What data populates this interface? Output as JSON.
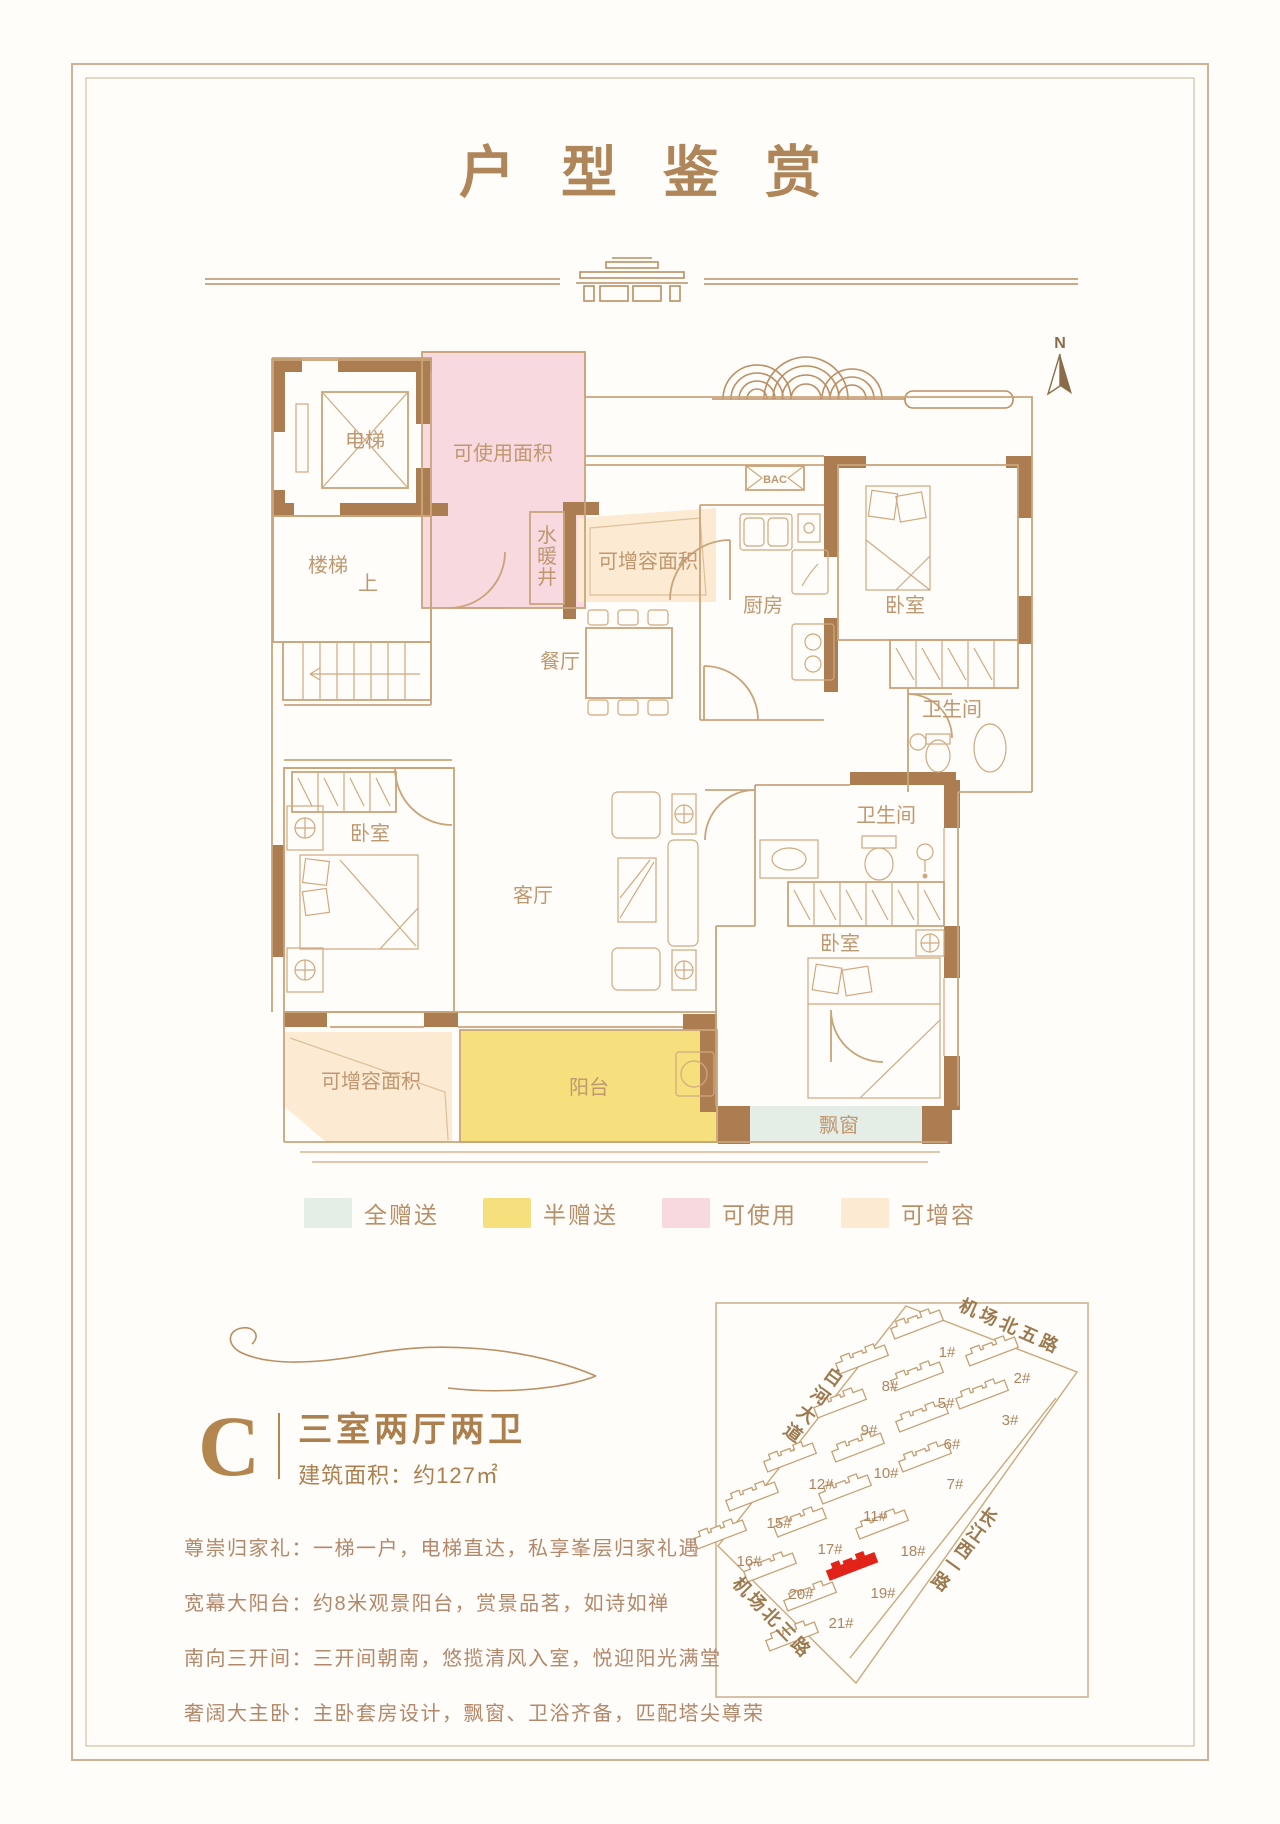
{
  "title": "户型鉴赏",
  "north": "N",
  "plan": {
    "elevator": "电梯",
    "stairs": "楼梯",
    "up": "上",
    "usable": "可使用面积",
    "shaft": [
      "水",
      "暖",
      "井"
    ],
    "expand_top": "可增容面积",
    "vent": "BAC",
    "kitchen": "厨房",
    "bedroom_tr": "卧室",
    "bath_tr": "卫生间",
    "dining": "餐厅",
    "bedroom_l": "卧室",
    "living": "客厅",
    "bath_m": "卫生间",
    "bedroom_m": "卧室",
    "expand_bottom": "可增容面积",
    "balcony": "阳台",
    "bay_window": "飘窗"
  },
  "legend": {
    "items": [
      {
        "label": "全赠送",
        "color": "#e4eee6"
      },
      {
        "label": "半赠送",
        "color": "#f6e07d"
      },
      {
        "label": "可使用",
        "color": "#f9d9e0"
      },
      {
        "label": "可增容",
        "color": "#fcead2"
      }
    ]
  },
  "unit": {
    "letter": "C",
    "layout": "三室两厅两卫",
    "area": "建筑面积：约127㎡"
  },
  "features": [
    "尊崇归家礼：一梯一户，电梯直达，私享峯层归家礼遇",
    "宽幕大阳台：约8米观景阳台，赏景品茗，如诗如禅",
    "南向三开间：三开间朝南，悠揽清风入室，悦迎阳光满堂",
    "奢阔大主卧：主卧套房设计，飘窗、卫浴齐备，匹配塔尖尊荣"
  ],
  "sitemap": {
    "highlight_color": "#e2231a",
    "roads": {
      "top": "机场北五路",
      "bottom": "机场北三路",
      "left": [
        "白",
        "河",
        "大",
        "道"
      ],
      "right": [
        "长",
        "江",
        "西",
        "一",
        "路"
      ]
    },
    "buildings": [
      "1#",
      "2#",
      "3#",
      "5#",
      "6#",
      "7#",
      "8#",
      "9#",
      "10#",
      "11#",
      "12#",
      "15#",
      "16#",
      "17#",
      "18#",
      "19#",
      "20#",
      "21#"
    ]
  }
}
